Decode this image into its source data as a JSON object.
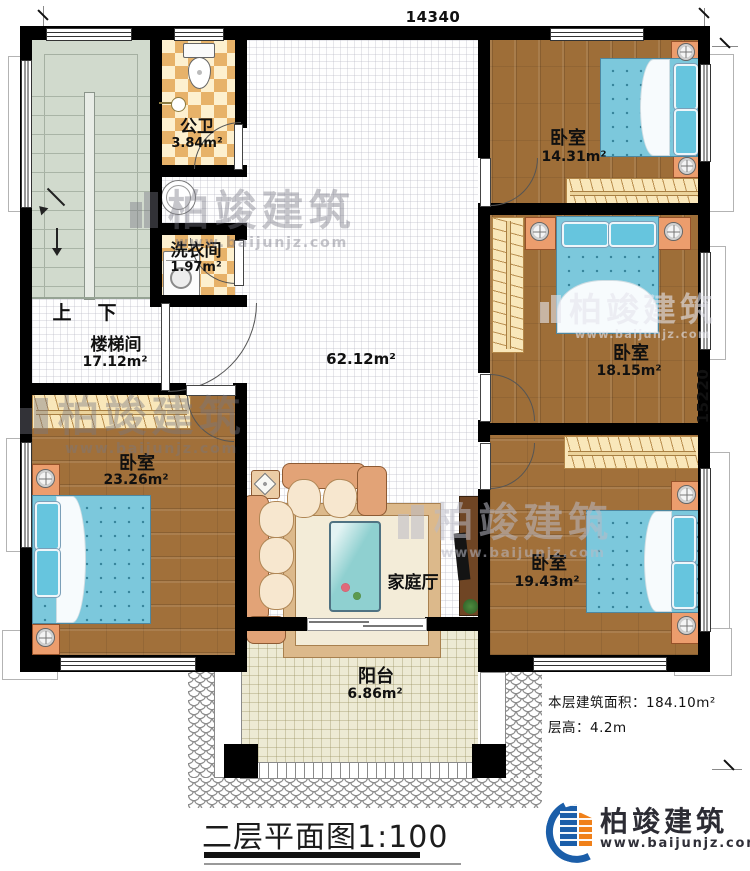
{
  "plan": {
    "dim_top": "14340",
    "dim_right": "15220",
    "stair": {
      "up": "上",
      "down": "下"
    },
    "rooms": {
      "bath": {
        "name": "公卫",
        "area": "3.84m²"
      },
      "laundry": {
        "name": "洗衣间",
        "area": "1.97m²"
      },
      "stairhall": {
        "name": "楼梯间",
        "area": "17.12m²"
      },
      "hall": {
        "name": "家庭厅",
        "area": "62.12m²"
      },
      "bedroom_top_right": {
        "name": "卧室",
        "area": "14.31m²"
      },
      "bedroom_mid_right": {
        "name": "卧室",
        "area": "18.15m²"
      },
      "bedroom_bottom_right": {
        "name": "卧室",
        "area": "19.43m²"
      },
      "bedroom_bottom_left": {
        "name": "卧室",
        "area": "23.26m²"
      },
      "balcony": {
        "name": "阳台",
        "area": "6.86m²"
      }
    }
  },
  "notes": {
    "floor_area": "本层建筑面积：184.10m²",
    "floor_height": "层高：4.2m"
  },
  "title": {
    "name": "二层平面图",
    "scale": "1:100"
  },
  "brand": {
    "name": "柏竣建筑",
    "site": "www.baijunjz.com"
  },
  "watermark": {
    "name": "柏竣建筑",
    "site": "www.baijunjz.com"
  },
  "colors": {
    "wall": "#000000",
    "wood": "#9e6e38",
    "bed": "#7cc8dc",
    "checker_tile": "#e7b269",
    "stair_floor": "#d1dacd",
    "balcony_floor": "#edead4",
    "logo_blue": "#1b5ea9",
    "logo_orange": "#f08019"
  }
}
